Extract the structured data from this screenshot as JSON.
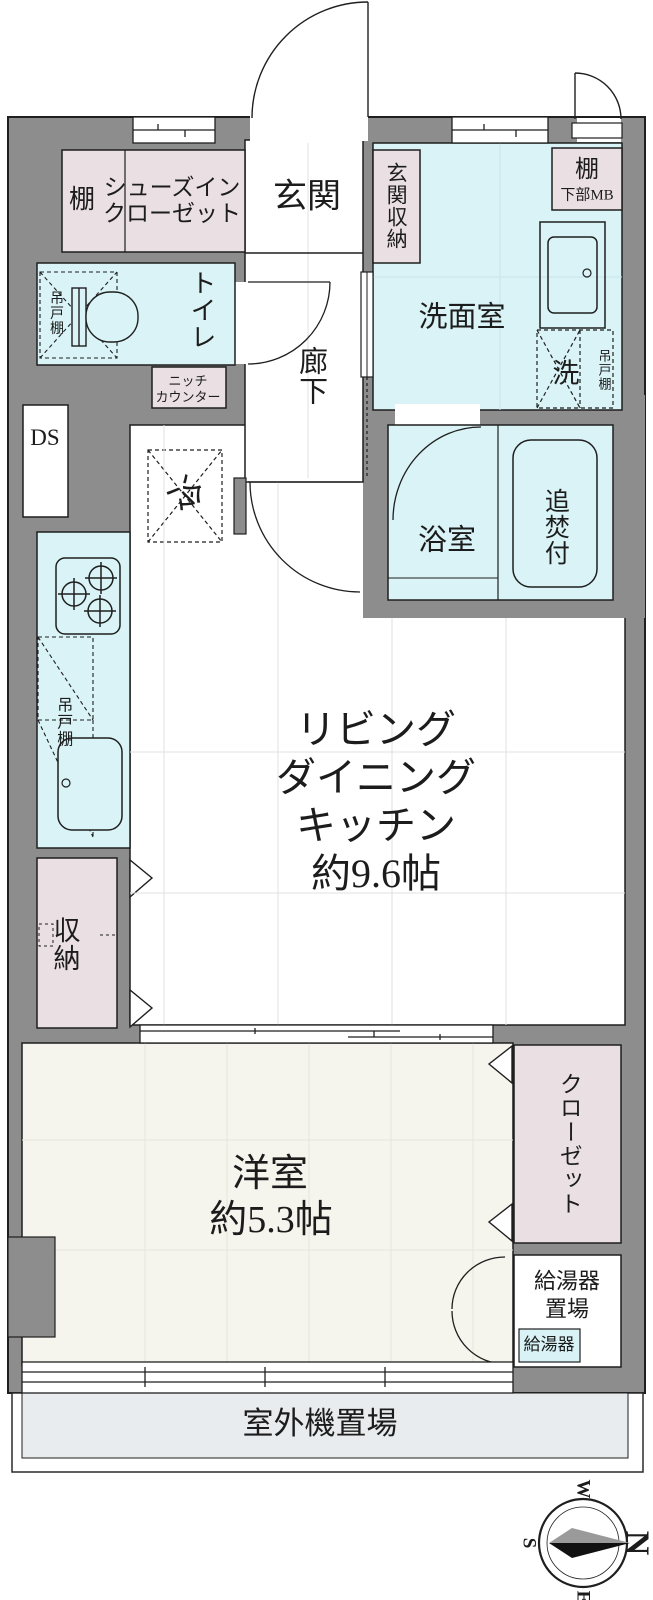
{
  "plan_title": "apartment-floor-plan",
  "colors": {
    "wall": "#8d8d8d",
    "water_rooms": "#d9f3f6",
    "storage_pink": "#eadfe3",
    "western_floor": "#f6f5ed",
    "balcony": "#e8ecee",
    "heater_label_bg": "#d8f2f6",
    "line": "#1f1f1f"
  },
  "labels": {
    "genkan": "玄関",
    "genkan_shunou": "玄関収納",
    "tana_shoes": "棚",
    "shoes_closet": [
      "シューズイン",
      "クローゼット"
    ],
    "tana_mb": "棚",
    "mb_sub": "下部MB",
    "senmenshitsu": "洗面室",
    "sen": "洗",
    "tsuridana_laundry": "吊戸棚",
    "toilet": "トイレ",
    "tsuridana_toilet": "吊戸棚",
    "niche": [
      "ニッチ",
      "カウンター"
    ],
    "rouka": "廊下",
    "ds": "DS",
    "rei": "冷",
    "yokushitsu": "浴室",
    "oidakitsuki": "追焚付",
    "tsuridana_kitchen": "吊戸棚",
    "ldk": [
      "リビング",
      "ダイニング",
      "キッチン",
      "約9.6帖"
    ],
    "shunou": "収納",
    "yoshitsu": [
      "洋室",
      "約5.3帖"
    ],
    "closet": "クローゼット",
    "kyutoki_okiba": [
      "給湯器",
      "置場"
    ],
    "kyutoki": "給湯器",
    "shitsugaiki": "室外機置場",
    "compass": {
      "n": "N",
      "e": "E",
      "s": "S",
      "w": "W"
    }
  }
}
